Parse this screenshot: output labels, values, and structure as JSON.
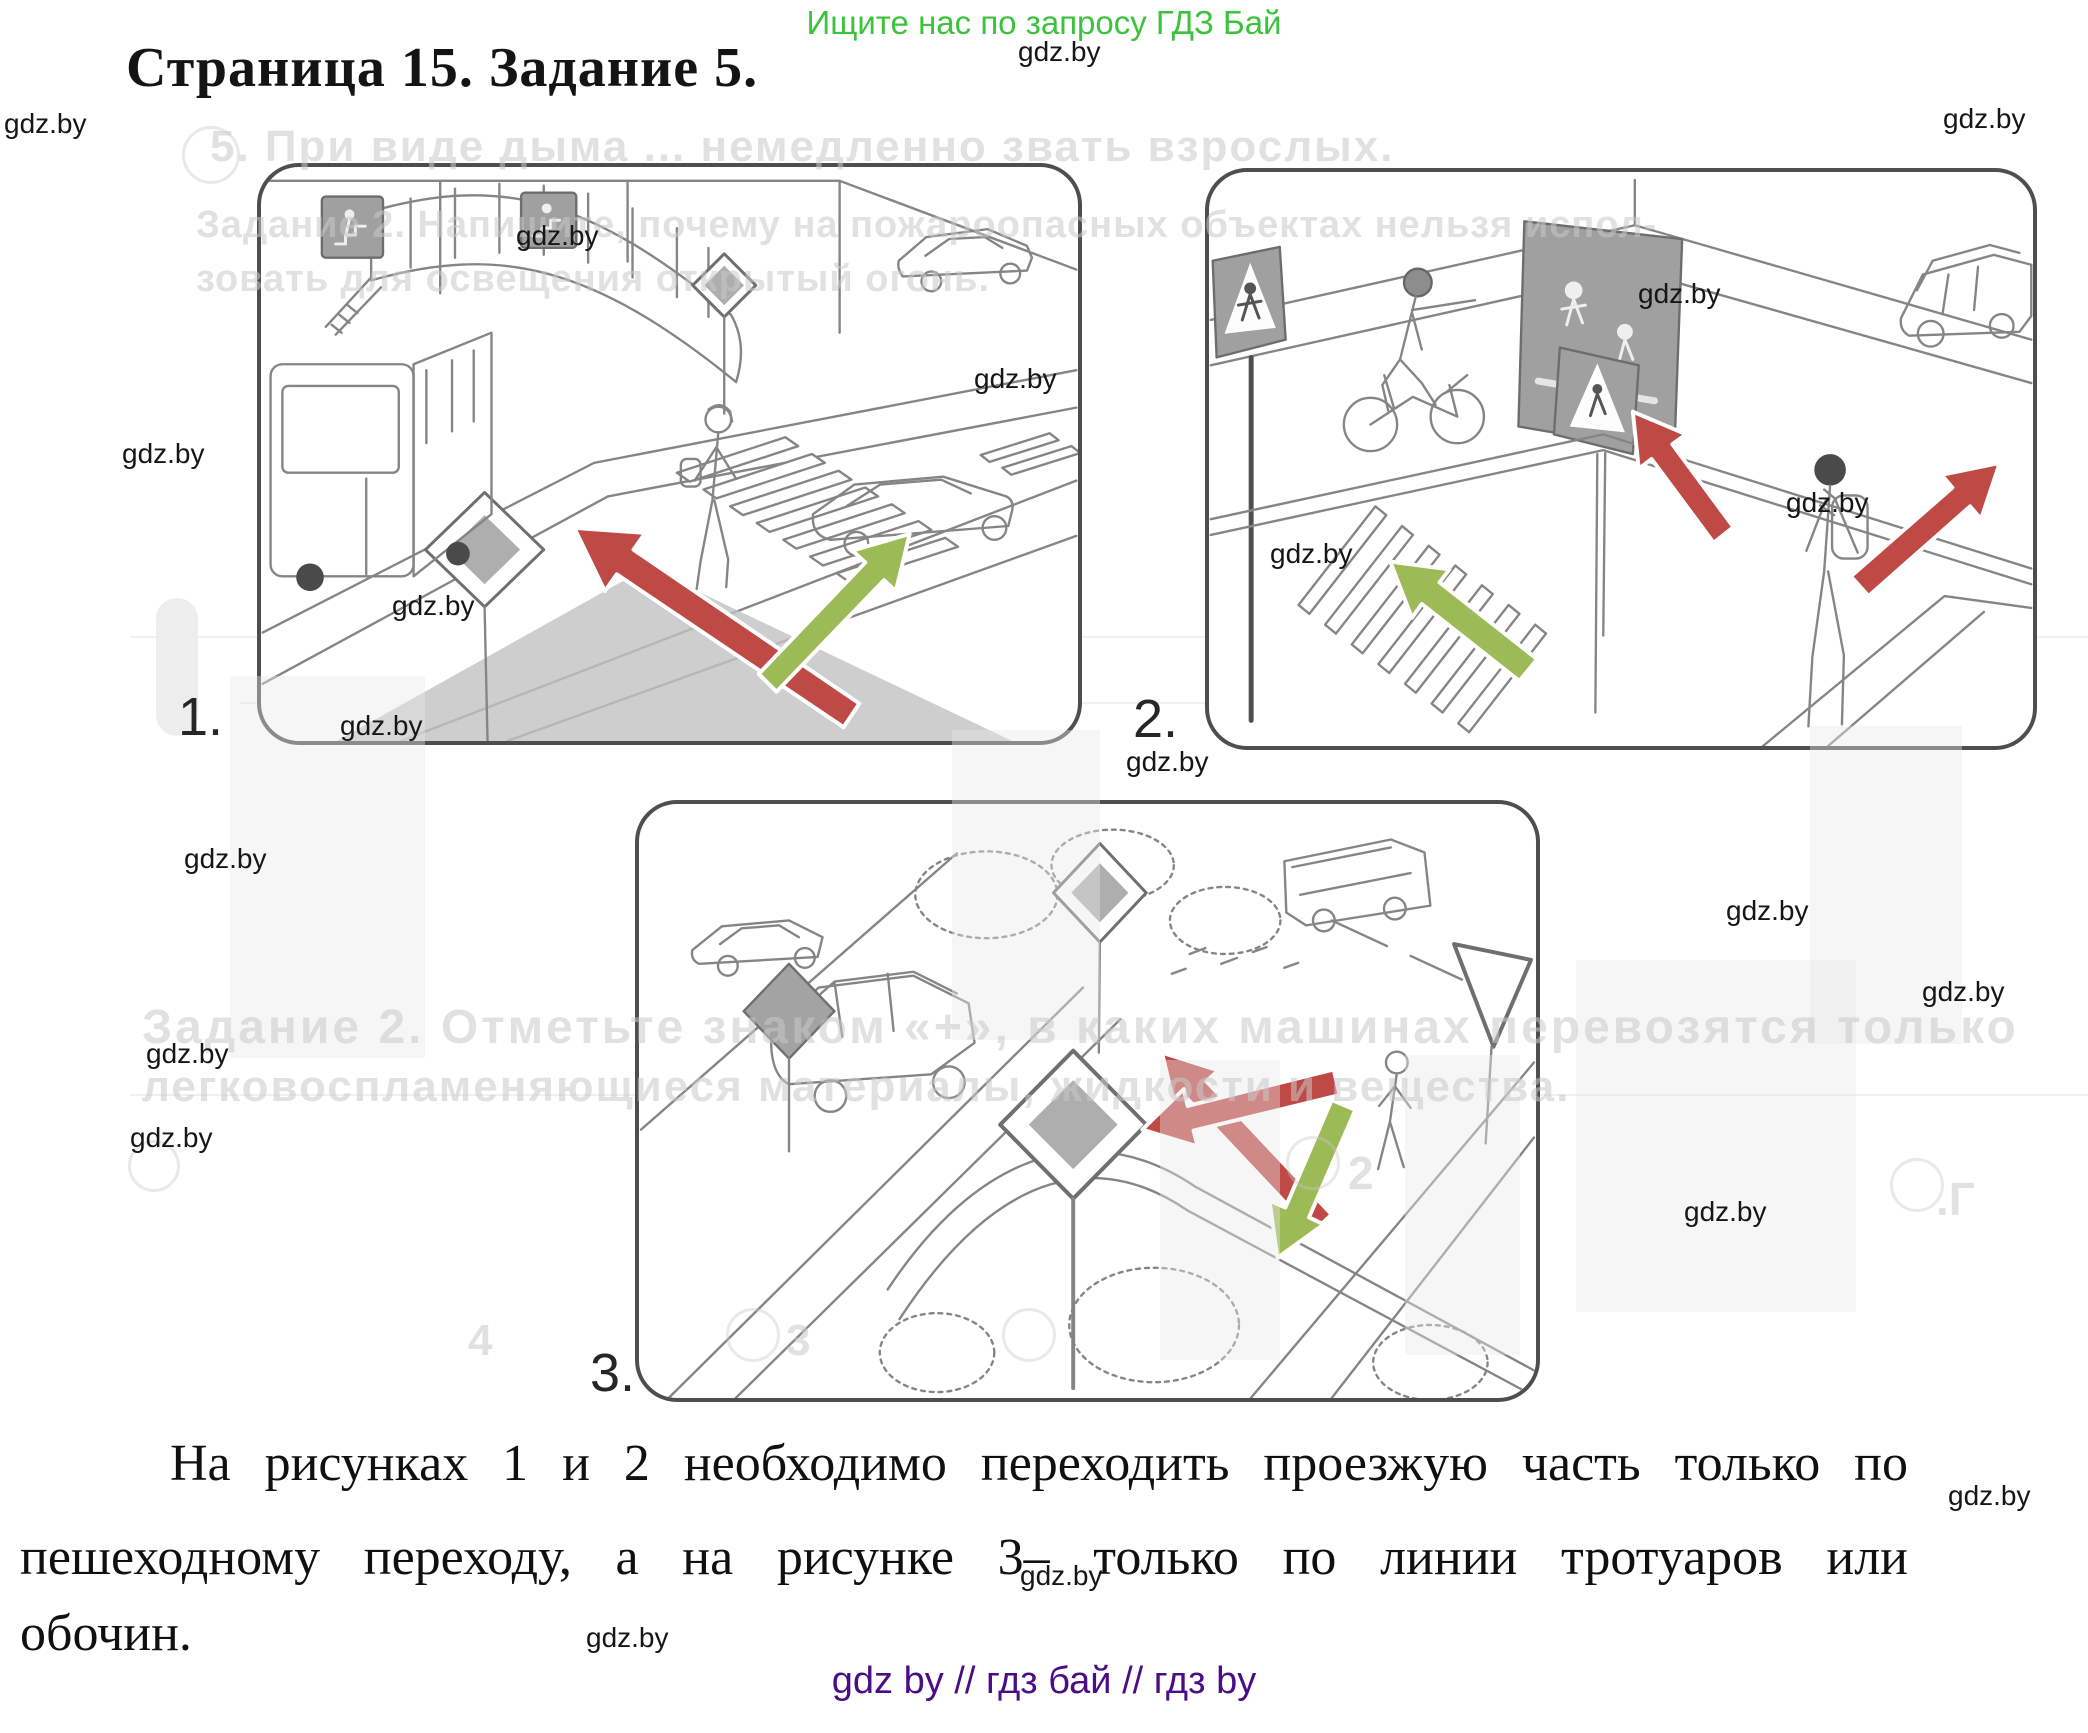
{
  "page": {
    "promo": "Ищите нас по запросу ГДЗ Бай",
    "title": "Страница 15. Задание 5.",
    "watermark_text": "gdz.by",
    "footer": "gdz by  //  гдз бай  //  гдз by"
  },
  "colors": {
    "promo_green": "#3cc23c",
    "footer_purple": "#4a0d86",
    "arrow_red": "#bf4a45",
    "arrow_green": "#9cba55",
    "watermark_dark": "#161616",
    "bleed_gray": "#c9c9c9"
  },
  "figures": [
    {
      "label": "1.",
      "alt": "street with overhead pedestrian bridge, bus, zebra crossing, red and green arrows"
    },
    {
      "label": "2.",
      "alt": "intersection with motorcyclist, crossing signs, boy with backpack, red and green arrows"
    },
    {
      "label": "3.",
      "alt": "rural crossroads with cars, main-road diamond signs, pedestrian, red and green arrows"
    }
  ],
  "answer": {
    "line1": "На рисунках 1 и 2 необходимо переходить проезжую часть только по",
    "line2": "пешеходному переходу, а на рисунке 3– только по линии тротуаров или",
    "line3": "обочин."
  },
  "watermarks": [
    [
      1018,
      36
    ],
    [
      1943,
      103
    ],
    [
      4,
      108
    ],
    [
      516,
      220
    ],
    [
      1638,
      278
    ],
    [
      974,
      363
    ],
    [
      122,
      438
    ],
    [
      1786,
      487
    ],
    [
      1270,
      538
    ],
    [
      392,
      590
    ],
    [
      340,
      710
    ],
    [
      1126,
      746
    ],
    [
      184,
      843
    ],
    [
      1726,
      895
    ],
    [
      1922,
      976
    ],
    [
      146,
      1038
    ],
    [
      130,
      1122
    ],
    [
      1684,
      1196
    ],
    [
      1948,
      1480
    ],
    [
      1020,
      1560
    ],
    [
      586,
      1622
    ]
  ],
  "bleed": {
    "lines": [
      {
        "text": "5. При виде дыма ... немедленно звать взрослых.",
        "x": 210,
        "y": 122,
        "size": 44,
        "ls": 2
      },
      {
        "text": "Задание 2. Напишите, почему на пожароопасных объектах нельзя испол-",
        "x": 196,
        "y": 204,
        "size": 38,
        "ls": 1
      },
      {
        "text": "зовать для освещения открытый огонь.",
        "x": 196,
        "y": 258,
        "size": 38,
        "ls": 1
      },
      {
        "text": "Задание 2. Отметьте знаком «+», в каких машинах перевозятся только",
        "x": 142,
        "y": 1000,
        "size": 48,
        "ls": 3
      },
      {
        "text": "легковоспламеняющиеся материалы, жидкости и вещества.",
        "x": 142,
        "y": 1062,
        "size": 44,
        "ls": 2
      }
    ],
    "fragments": [
      {
        "text": "2",
        "x": 1348,
        "y": 1146,
        "size": 46
      },
      {
        "text": ".Г",
        "x": 1936,
        "y": 1172,
        "size": 46
      },
      {
        "text": "3",
        "x": 786,
        "y": 1316,
        "size": 44
      },
      {
        "text": "4",
        "x": 468,
        "y": 1316,
        "size": 44
      }
    ],
    "circles": [
      [
        182,
        126,
        52
      ],
      [
        128,
        1140,
        46
      ],
      [
        726,
        1308,
        48
      ],
      [
        1002,
        1308,
        48
      ],
      [
        1286,
        1136,
        48
      ],
      [
        1890,
        1158,
        48
      ]
    ],
    "strips": [
      [
        230,
        676,
        195,
        382
      ],
      [
        1576,
        960,
        280,
        352
      ],
      [
        1810,
        726,
        152,
        318
      ],
      [
        952,
        730,
        148,
        310
      ],
      [
        1160,
        1060,
        120,
        300
      ],
      [
        1405,
        1055,
        115,
        300
      ]
    ],
    "pill": [
      156,
      598,
      42,
      138
    ],
    "streaks": [
      [
        130,
        636,
        1958
      ],
      [
        240,
        702,
        1600
      ],
      [
        130,
        1094,
        1958
      ]
    ]
  }
}
